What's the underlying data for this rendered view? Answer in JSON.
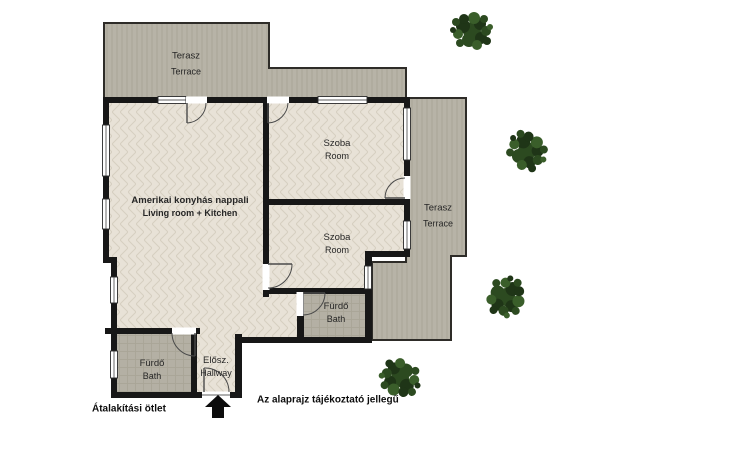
{
  "plan": {
    "rooms": [
      {
        "key": "terrace_top",
        "hu": "Terasz",
        "en": "Terrace"
      },
      {
        "key": "living",
        "hu": "Amerikai konyhás nappali",
        "en": "Living room + Kitchen"
      },
      {
        "key": "room1",
        "hu": "Szoba",
        "en": "Room"
      },
      {
        "key": "room2",
        "hu": "Szoba",
        "en": "Room"
      },
      {
        "key": "terrace_right",
        "hu": "Terasz",
        "en": "Terrace"
      },
      {
        "key": "bath2",
        "hu": "Fürdő",
        "en": "Bath"
      },
      {
        "key": "bath1",
        "hu": "Fürdő",
        "en": "Bath"
      },
      {
        "key": "hallway",
        "hu": "Elősz.",
        "en": "Hallway"
      }
    ],
    "captions": {
      "idea": "Átalakítási ötlet",
      "disclaimer": "Az alaprajz tájékoztató jellegű"
    }
  },
  "colors": {
    "wall": "#171717",
    "floor": "#e8e2d7",
    "floor_line": "#d6cfc1",
    "terrace": "#b7b3a7",
    "terrace_line": "#a9a597",
    "terrace_edge": "#2e2c28",
    "bath": "#b4b0a4",
    "tree_dark": "#1f3517",
    "tree_mid": "#2c4a20",
    "tree_light": "#3a5e2a",
    "text": "#262626",
    "caption": "#0d0d0d"
  }
}
